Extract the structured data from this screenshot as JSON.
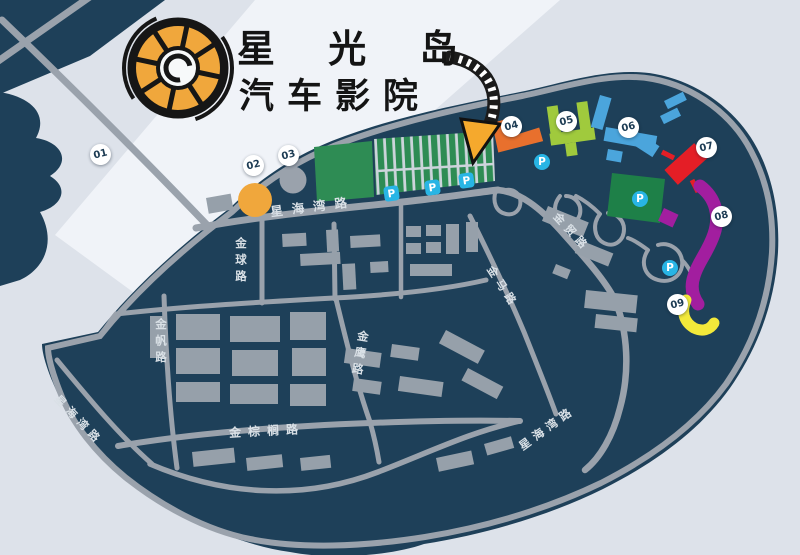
{
  "logo": {
    "line1": "星 光 岛",
    "line2": "汽车影院",
    "icon": "film-reel-wheel-icon"
  },
  "markers": [
    "01",
    "02",
    "03",
    "04",
    "05",
    "06",
    "07",
    "08",
    "09"
  ],
  "roads": {
    "xinghaiwan_north": "星海湾路",
    "xinghaiwan_west": "星海湾路",
    "xinghaiwan_southeast": "星海湾路",
    "jinqiu": "金球路",
    "jinfan": "金帆路",
    "jinying": "金鹰路",
    "jinzonglv": "金棕榈路",
    "jinma": "金马路",
    "jinmao": "金贸路"
  },
  "parking_label": "P",
  "colors": {
    "background": "#DDE2EA",
    "island": "#1E4059",
    "road": "#9AA2AC",
    "cinema_green": "#2E8C54",
    "park_green": "#1E8048",
    "zone_02": "#F0A73C",
    "zone_03": "#9AA2AC",
    "zone_04": "#E8702D",
    "zone_05": "#A0CA3D",
    "zone_06": "#4BA5DC",
    "zone_07": "#E41E26",
    "zone_08": "#A21E9F",
    "zone_09": "#F3E93A",
    "parking_badge": "#28B5E5",
    "logo_orange": "#F0A73C",
    "arrow_orange": "#F5A92D"
  }
}
